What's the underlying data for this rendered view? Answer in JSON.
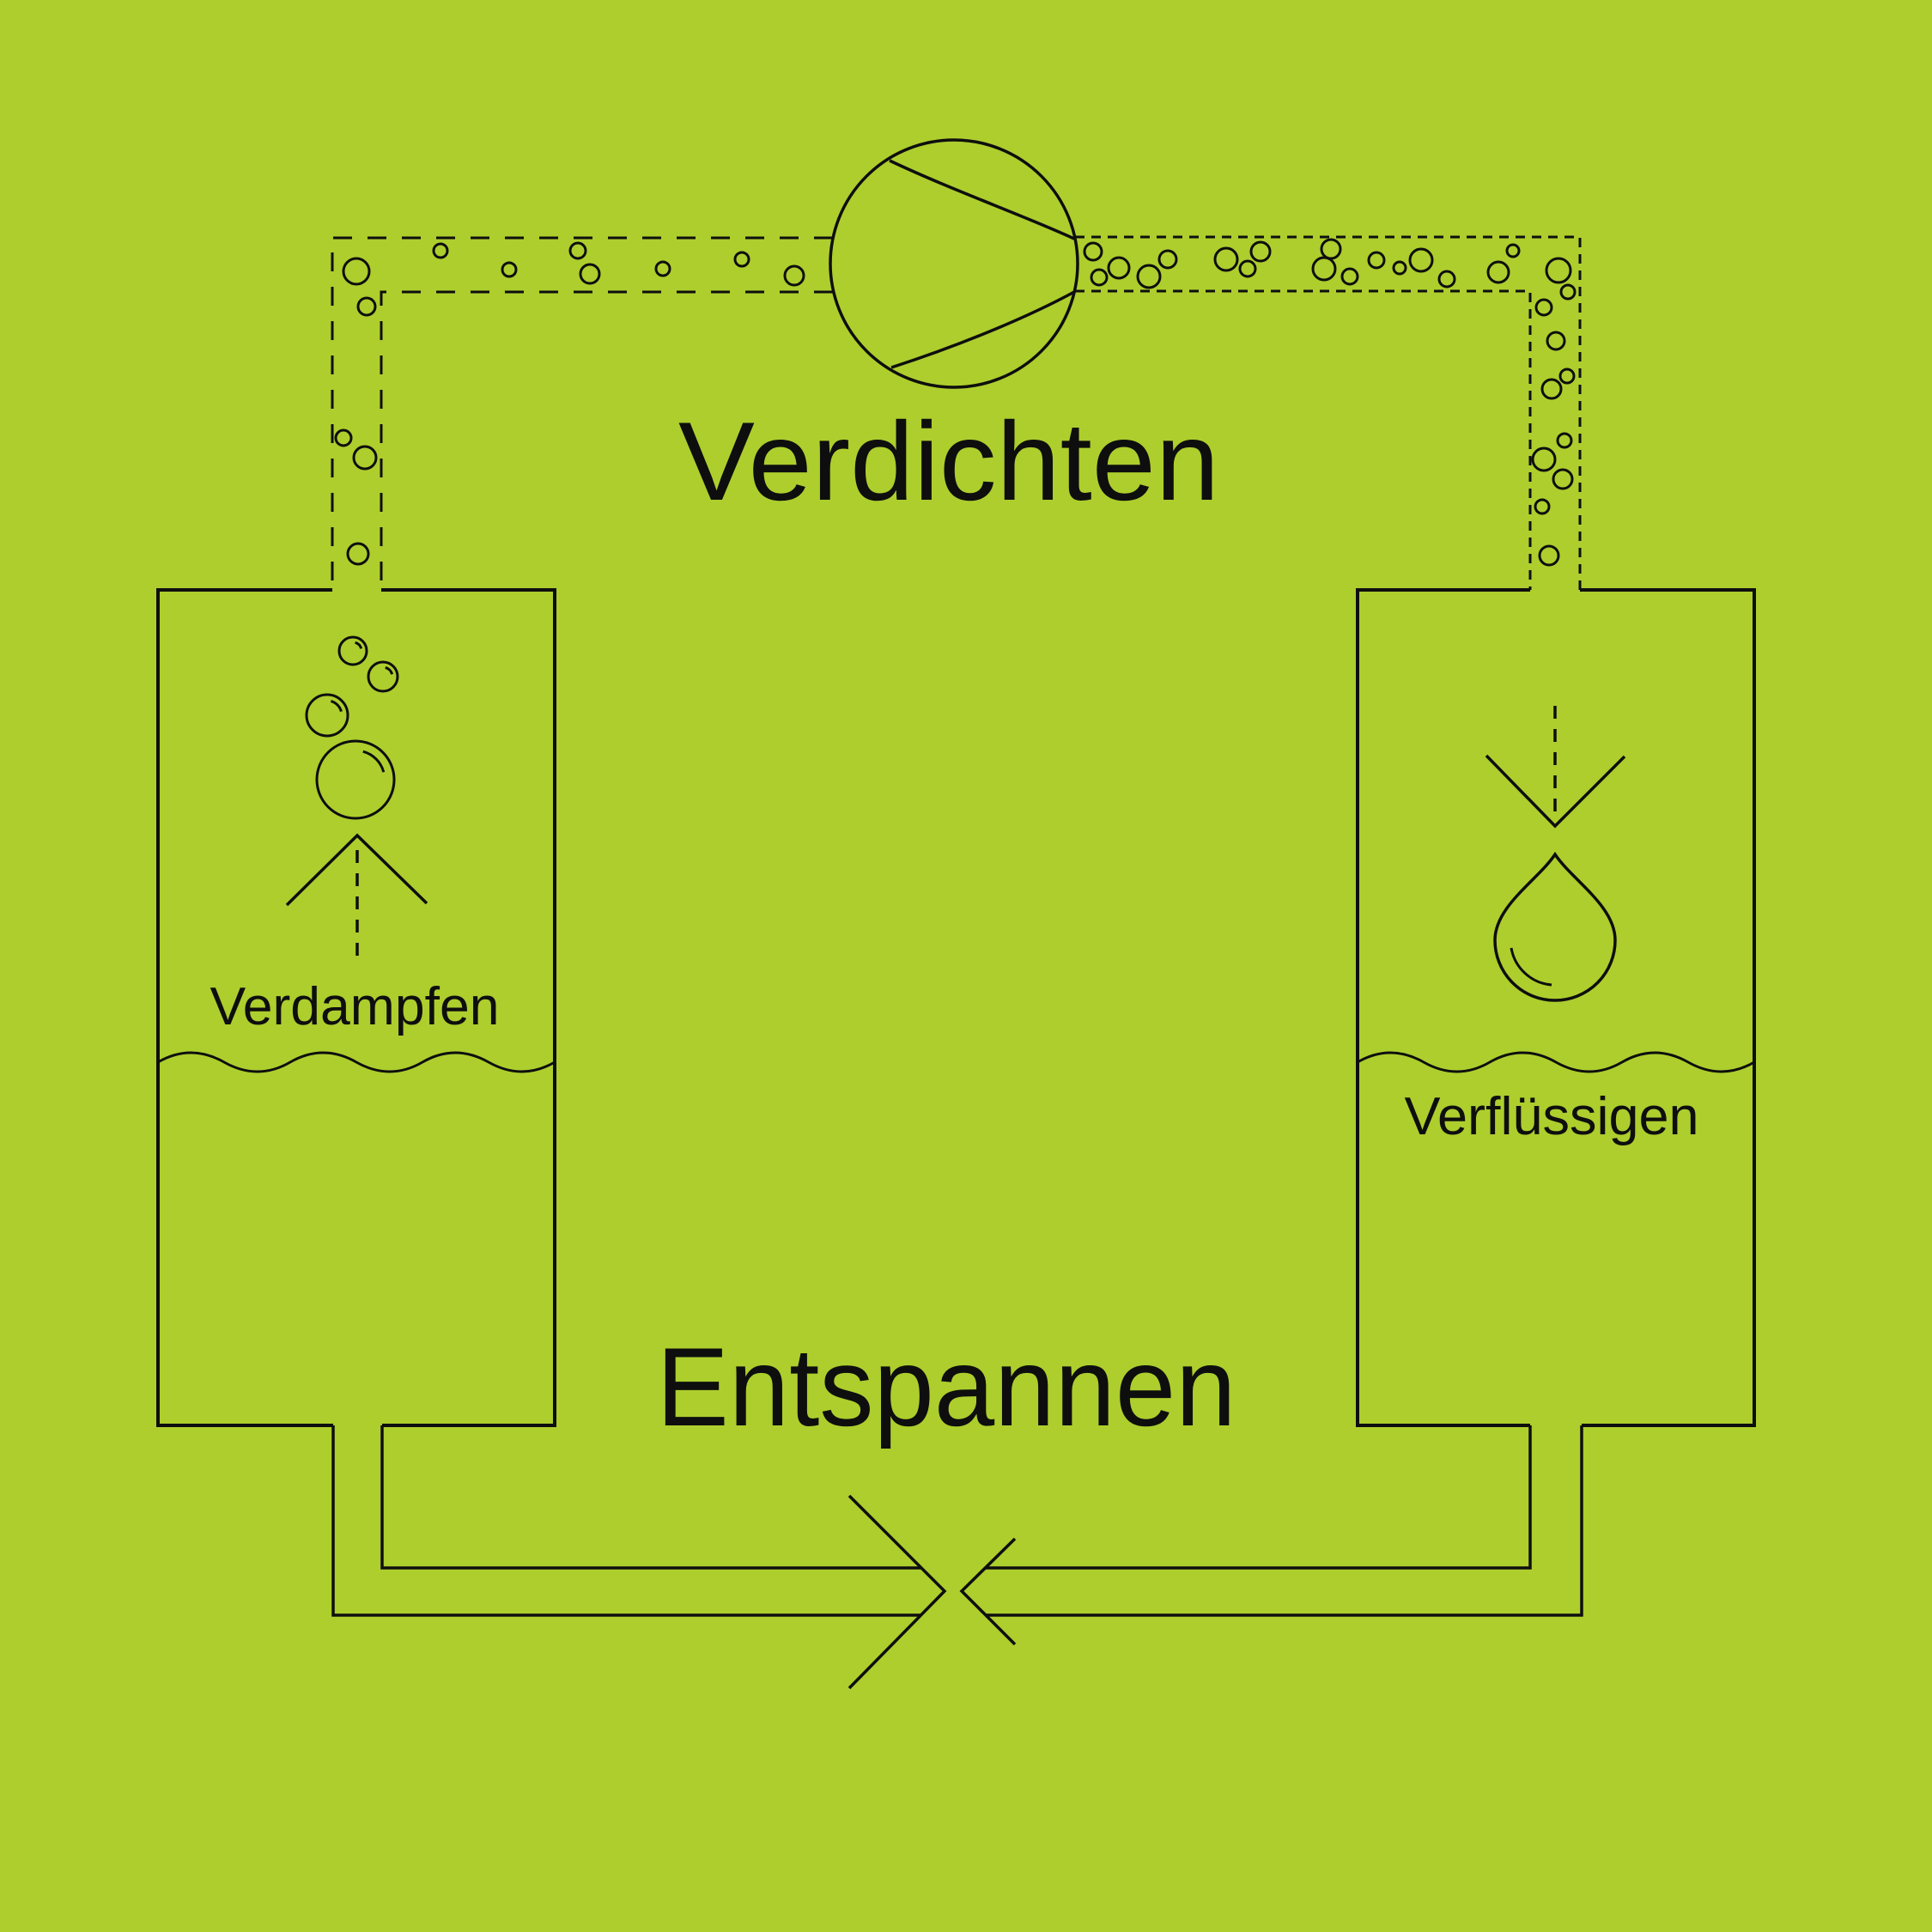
{
  "diagram": {
    "type": "heat-pump-refrigeration-cycle",
    "title_top": "Verdichten",
    "title_bottom": "Entspannen",
    "left_tank_label": "Verdampfen",
    "right_tank_label": "Verflüssigen"
  },
  "colors": {
    "background": "#adce2d",
    "line": "#0e0e0e"
  },
  "icons": {
    "compressor": "circle-with-converging-suction-lines",
    "expansion_valve": "opposing-chevrons",
    "evaporator_bubbles": "rising-bubbles",
    "condenser_droplet": "water-drop",
    "up_arrow": "chevron-up-with-dashed-stem",
    "down_arrow": "chevron-down-with-dashed-stem",
    "liquid_level": "wavy-line"
  }
}
